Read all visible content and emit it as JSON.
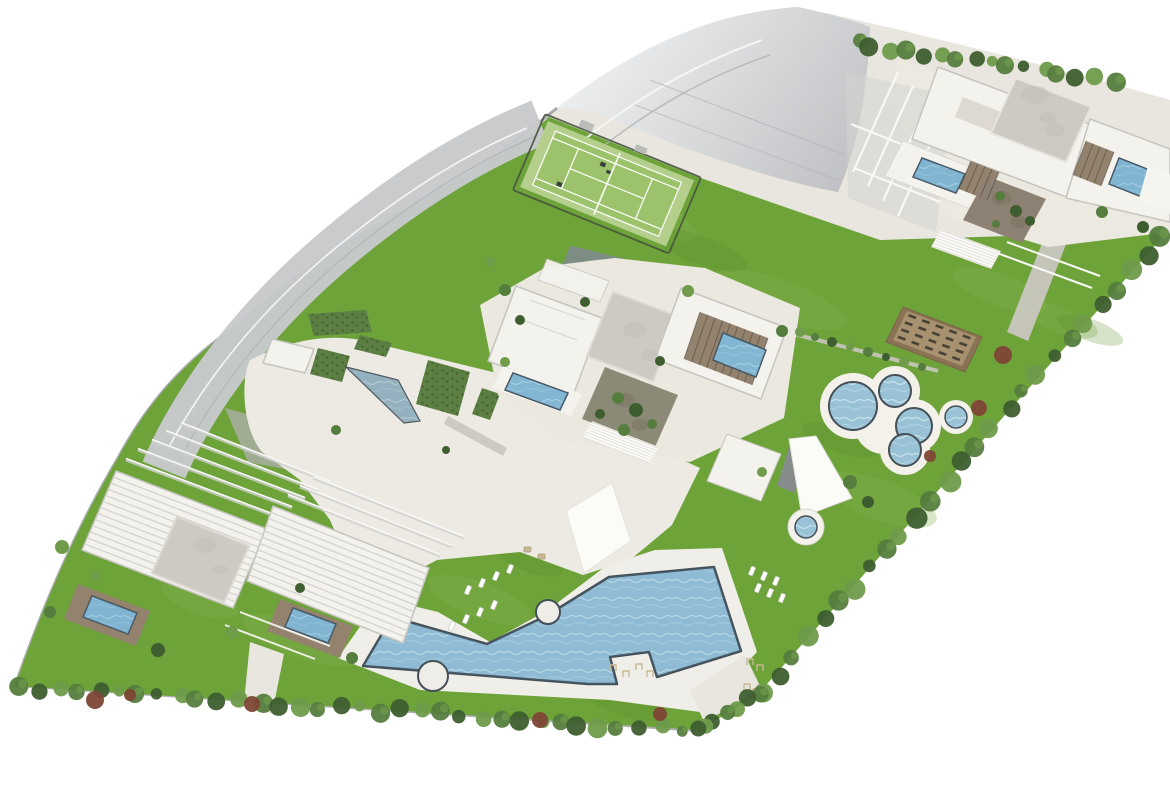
{
  "palette": {
    "background": "#ffffff",
    "paving": "#e9e6df",
    "paving_light": "#f0eee8",
    "plaza": "#eceae2",
    "asphalt_light": "#eef0f1",
    "asphalt_dark": "#bfc1c4",
    "asphalt_road": "#c7c9cb",
    "road_marking_white": "#f7f7f6",
    "road_marking_grey": "#b2b4b7",
    "ramp_green_grey": "#a9aea2",
    "lawn": "#6da339",
    "lawn_light": "#85b44e",
    "lawn_dark": "#5b8c2d",
    "tennis_apron": "#b3cf8b",
    "tennis_court": "#9cc36c",
    "tennis_line": "#ffffff",
    "tennis_fence": "#46523f",
    "pond": "#7d8d83",
    "water_base": "#9ac2d6",
    "water_ripple": "#cfe6f0",
    "water_ripple_soft": "#bcd9e7",
    "water_tint": "#4f9cc9",
    "pool_rim": "#454f57",
    "deck_white": "#f3f1ea",
    "deck_brown": "#93826d",
    "slat_dark": "#4a443a",
    "planter_border": "#8a7254",
    "planter_soil": "#a8916f",
    "planter_slat": "#3d382f",
    "courtyard_brown": "#8d8173",
    "courtyard_olive": "#8b8a76",
    "roof_white": "#f4f2ed",
    "roof_grey": "#cdcac3",
    "roof_line": "#d4d3cf",
    "frame_white": "#f8f8f6",
    "building_stroke": "#c6c4bf",
    "path_grey": "#c9c6bf",
    "tree_green": "#557d3e",
    "tree_green_dark": "#3e5e2f",
    "tree_green_light": "#6f9b4a",
    "tree_red": "#7e4636",
    "hedge": "#5d7f44",
    "furniture_tan": "#c9b894",
    "furniture_white": "#ffffff",
    "wall_grey": "#95979b",
    "sail_white": "#fbfbf8",
    "water_dark_feature": "#868c8c",
    "stairs_base": "#e8e5de",
    "grey_mottle": "#c2bfb7"
  },
  "features": {
    "site": "aerial-3d-masterplan",
    "parking": "parking-and-access-road",
    "tennis": "tennis-court",
    "pond": "reflecting-pond",
    "main_pool": "zigzag-resort-pool",
    "circle_pools": "circular-pool-cluster",
    "spa": "round-spa",
    "planter": "community-garden-beds",
    "clusters": [
      "north-east-villa-cluster",
      "central-villa-cluster",
      "south-west-villa-cluster"
    ]
  }
}
